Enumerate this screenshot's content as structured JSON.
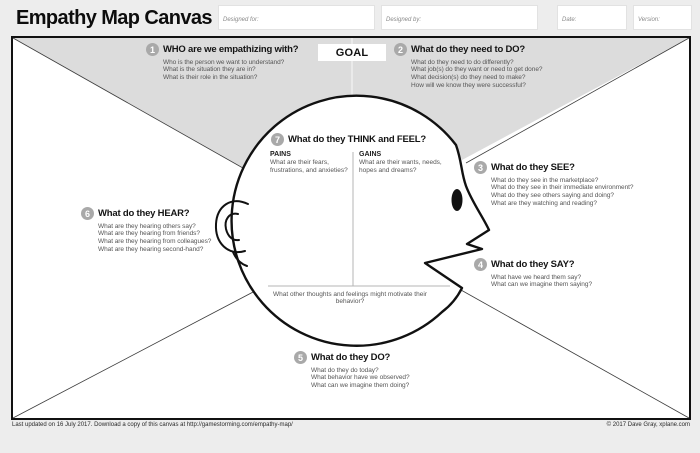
{
  "header": {
    "title": "Empathy Map Canvas",
    "designed_for_label": "Designed for:",
    "designed_by_label": "Designed by:",
    "date_label": "Date:",
    "version_label": "Version:"
  },
  "goal_label": "GOAL",
  "sections": {
    "who": {
      "number": "1",
      "title": "WHO are we empathizing with?",
      "questions": [
        "Who is the person we want to understand?",
        "What is the situation they are in?",
        "What is their role in the situation?"
      ]
    },
    "do_need": {
      "number": "2",
      "title": "What do they need to DO?",
      "questions": [
        "What do they need to do differently?",
        "What job(s) do they want or need to get done?",
        "What decision(s) do they need to make?",
        "How will we know they were successful?"
      ]
    },
    "see": {
      "number": "3",
      "title": "What do they SEE?",
      "questions": [
        "What do they see in the marketplace?",
        "What do they see in their immediate environment?",
        "What do they see others saying and doing?",
        "What are they watching and reading?"
      ]
    },
    "say": {
      "number": "4",
      "title": "What do they SAY?",
      "questions": [
        "What have we heard them say?",
        "What can we imagine them saying?"
      ]
    },
    "do": {
      "number": "5",
      "title": "What do they DO?",
      "questions": [
        "What do they do today?",
        "What behavior have we observed?",
        "What can we imagine them doing?"
      ]
    },
    "hear": {
      "number": "6",
      "title": "What do they HEAR?",
      "questions": [
        "What are they hearing others say?",
        "What are they hearing from friends?",
        "What are they hearing from colleagues?",
        "What are they hearing second-hand?"
      ]
    },
    "think_feel": {
      "number": "7",
      "title": "What do they THINK and FEEL?",
      "pains_label": "PAINS",
      "pains_text": "What are their fears, frustrations, and anxieties?",
      "gains_label": "GAINS",
      "gains_text": "What are their wants, needs, hopes and dreams?",
      "footer_question": "What other thoughts and feelings might motivate their behavior?"
    }
  },
  "footer": {
    "left": "Last updated on 16 July 2017. Download a copy of this canvas at http://gamestorming.com/empathy-map/",
    "right": "© 2017 Dave Gray, xplane.com"
  },
  "colors": {
    "canvas_bg": "#ffffff",
    "top_region": "#dcdcdc",
    "badge": "#a9a9a9",
    "outline": "#111111",
    "page_bg": "#ededed"
  }
}
